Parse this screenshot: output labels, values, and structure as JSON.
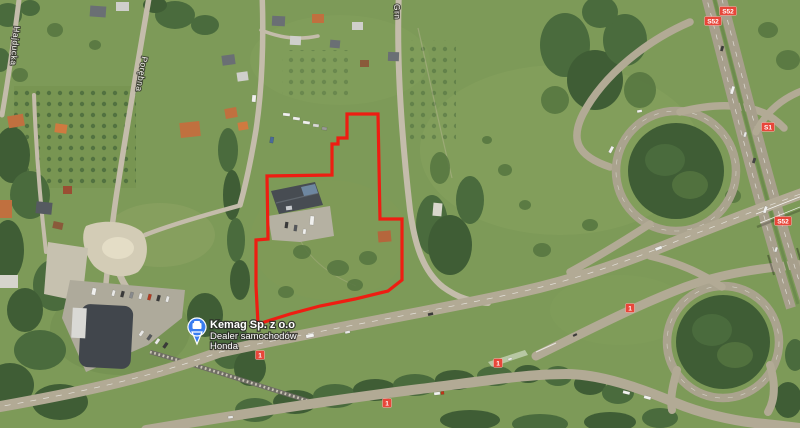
{
  "map": {
    "view_type": "satellite",
    "poi": {
      "title": "Kemag Sp. z o.o",
      "subtitle": "Dealer samochodów",
      "brand": "Honda",
      "pin_color": "#3a7df0"
    },
    "street_labels": [
      {
        "name": "Hajducka"
      },
      {
        "name": "Porębna"
      },
      {
        "name": "Grn"
      }
    ],
    "route_shields": [
      {
        "label": "S52"
      },
      {
        "label": "S52"
      },
      {
        "label": "S1"
      },
      {
        "label": "S52"
      },
      {
        "label": "1"
      },
      {
        "label": "1"
      },
      {
        "label": "1"
      },
      {
        "label": "1"
      }
    ],
    "parcel": {
      "outline_color": "#ee1d12"
    },
    "colors": {
      "grass": "#7d9a58",
      "forest": "#3f5d35",
      "road": "#b2aa95",
      "motorway": "#a79f8c",
      "shield_red": "#e8463a"
    }
  }
}
